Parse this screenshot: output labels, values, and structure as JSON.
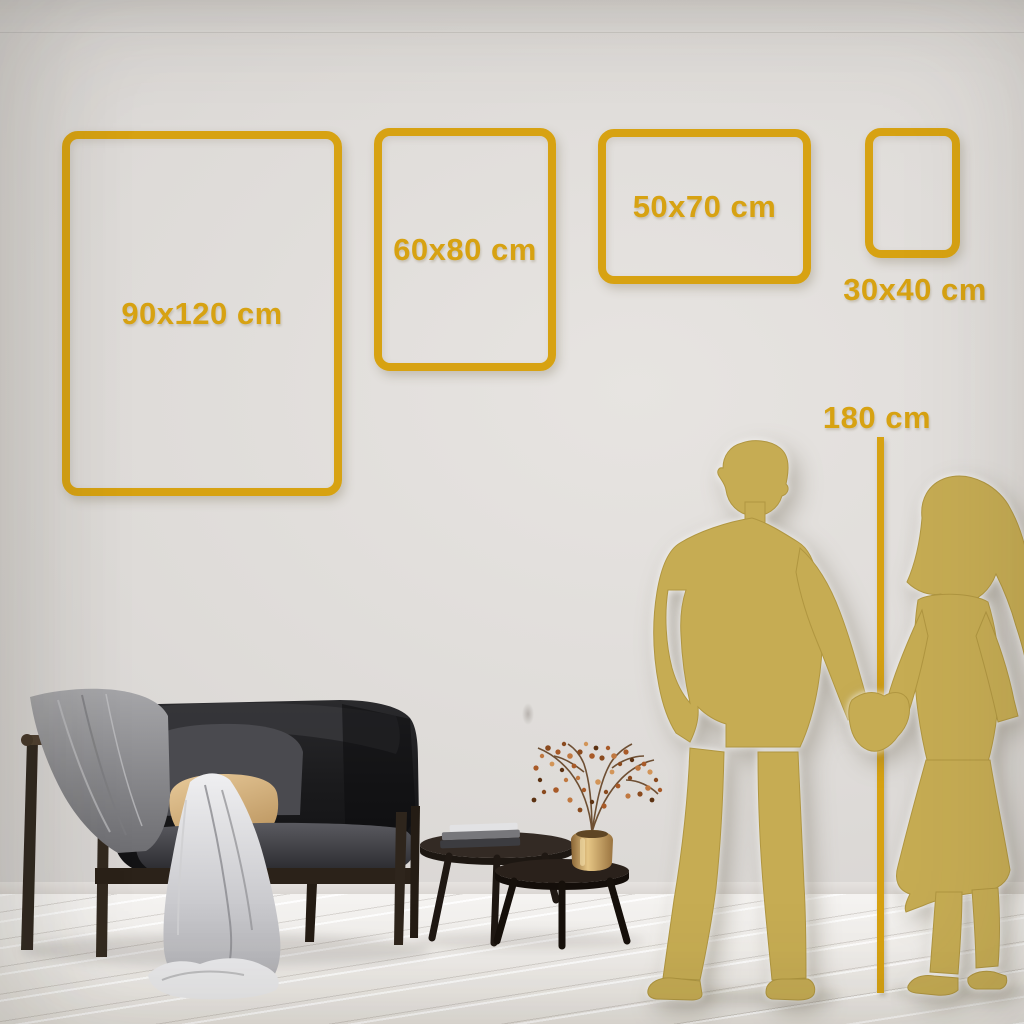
{
  "size_guide": {
    "frames": [
      {
        "id": "frame-90x120",
        "label": "90x120 cm",
        "width_cm": 90,
        "height_cm": 120,
        "label_placement": "inside"
      },
      {
        "id": "frame-60x80",
        "label": "60x80 cm",
        "width_cm": 60,
        "height_cm": 80,
        "label_placement": "inside"
      },
      {
        "id": "frame-50x70",
        "label": "50x70 cm",
        "width_cm": 50,
        "height_cm": 70,
        "label_placement": "inside"
      },
      {
        "id": "frame-30x40",
        "label": "30x40 cm",
        "width_cm": 30,
        "height_cm": 40,
        "label_placement": "below"
      }
    ],
    "height_reference": {
      "label": "180 cm",
      "value_cm": 180
    }
  },
  "scene": {
    "objects": [
      "dark-velvet-sofa",
      "gray-throw-blanket",
      "white-drape",
      "beige-pillow",
      "gray-pillow",
      "nesting-coffee-tables",
      "stacked-books",
      "brass-vase",
      "dried-berry-branches",
      "man-silhouette",
      "woman-silhouette",
      "white-plank-floor",
      "light-gray-wall"
    ]
  },
  "colors": {
    "accent_gold": "#D7A212",
    "silhouette_gold": "#C6AC53",
    "wall_light": "#E7E4E1",
    "wall_dark": "#CFCCCA",
    "floor_base": "#EDEAE6"
  }
}
